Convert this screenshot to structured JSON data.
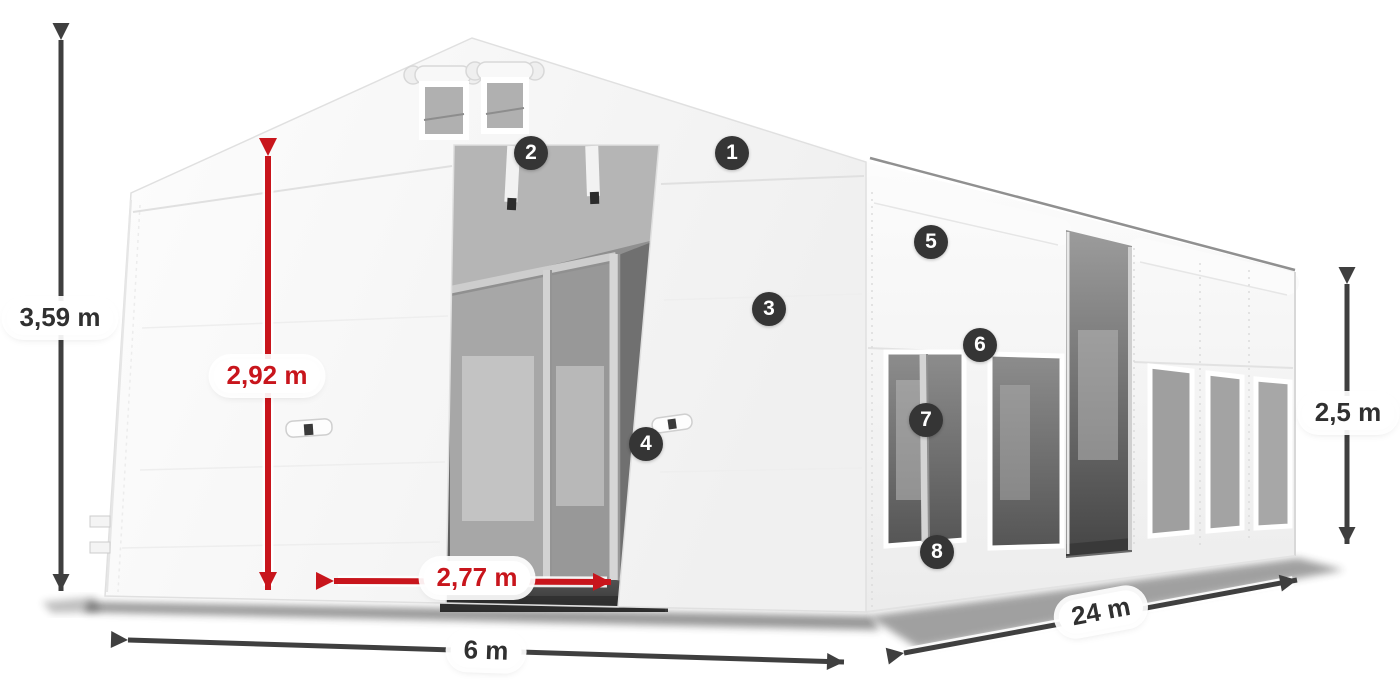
{
  "annotations": {
    "dimensions": [
      {
        "id": "total-height",
        "value": "3,59 m",
        "style": "dark",
        "orientation": "vertical"
      },
      {
        "id": "door-height",
        "value": "2,92 m",
        "style": "red",
        "orientation": "vertical"
      },
      {
        "id": "door-width",
        "value": "2,77 m",
        "style": "red",
        "orientation": "horizontal"
      },
      {
        "id": "front-width",
        "value": "6 m",
        "style": "dark",
        "orientation": "horizontal"
      },
      {
        "id": "length",
        "value": "24 m",
        "style": "dark",
        "orientation": "diagonal"
      },
      {
        "id": "side-height",
        "value": "2,5 m",
        "style": "dark",
        "orientation": "vertical"
      }
    ],
    "callouts": [
      {
        "number": "1"
      },
      {
        "number": "2"
      },
      {
        "number": "3"
      },
      {
        "number": "4"
      },
      {
        "number": "5"
      },
      {
        "number": "6"
      },
      {
        "number": "7"
      },
      {
        "number": "8"
      }
    ]
  },
  "colors": {
    "accent_red": "#c8151c",
    "dimension_arrow_gray": "#3f3f3f",
    "badge_background": "#353535",
    "badge_text": "#ffffff",
    "label_background": "#ffffff",
    "label_text_dark": "#303030",
    "canvas_background": "#ffffff",
    "tent_fabric_white": "#f5f5f5",
    "window_gray": "#9e9e9e",
    "interior_gray": "#6b6b6b"
  }
}
